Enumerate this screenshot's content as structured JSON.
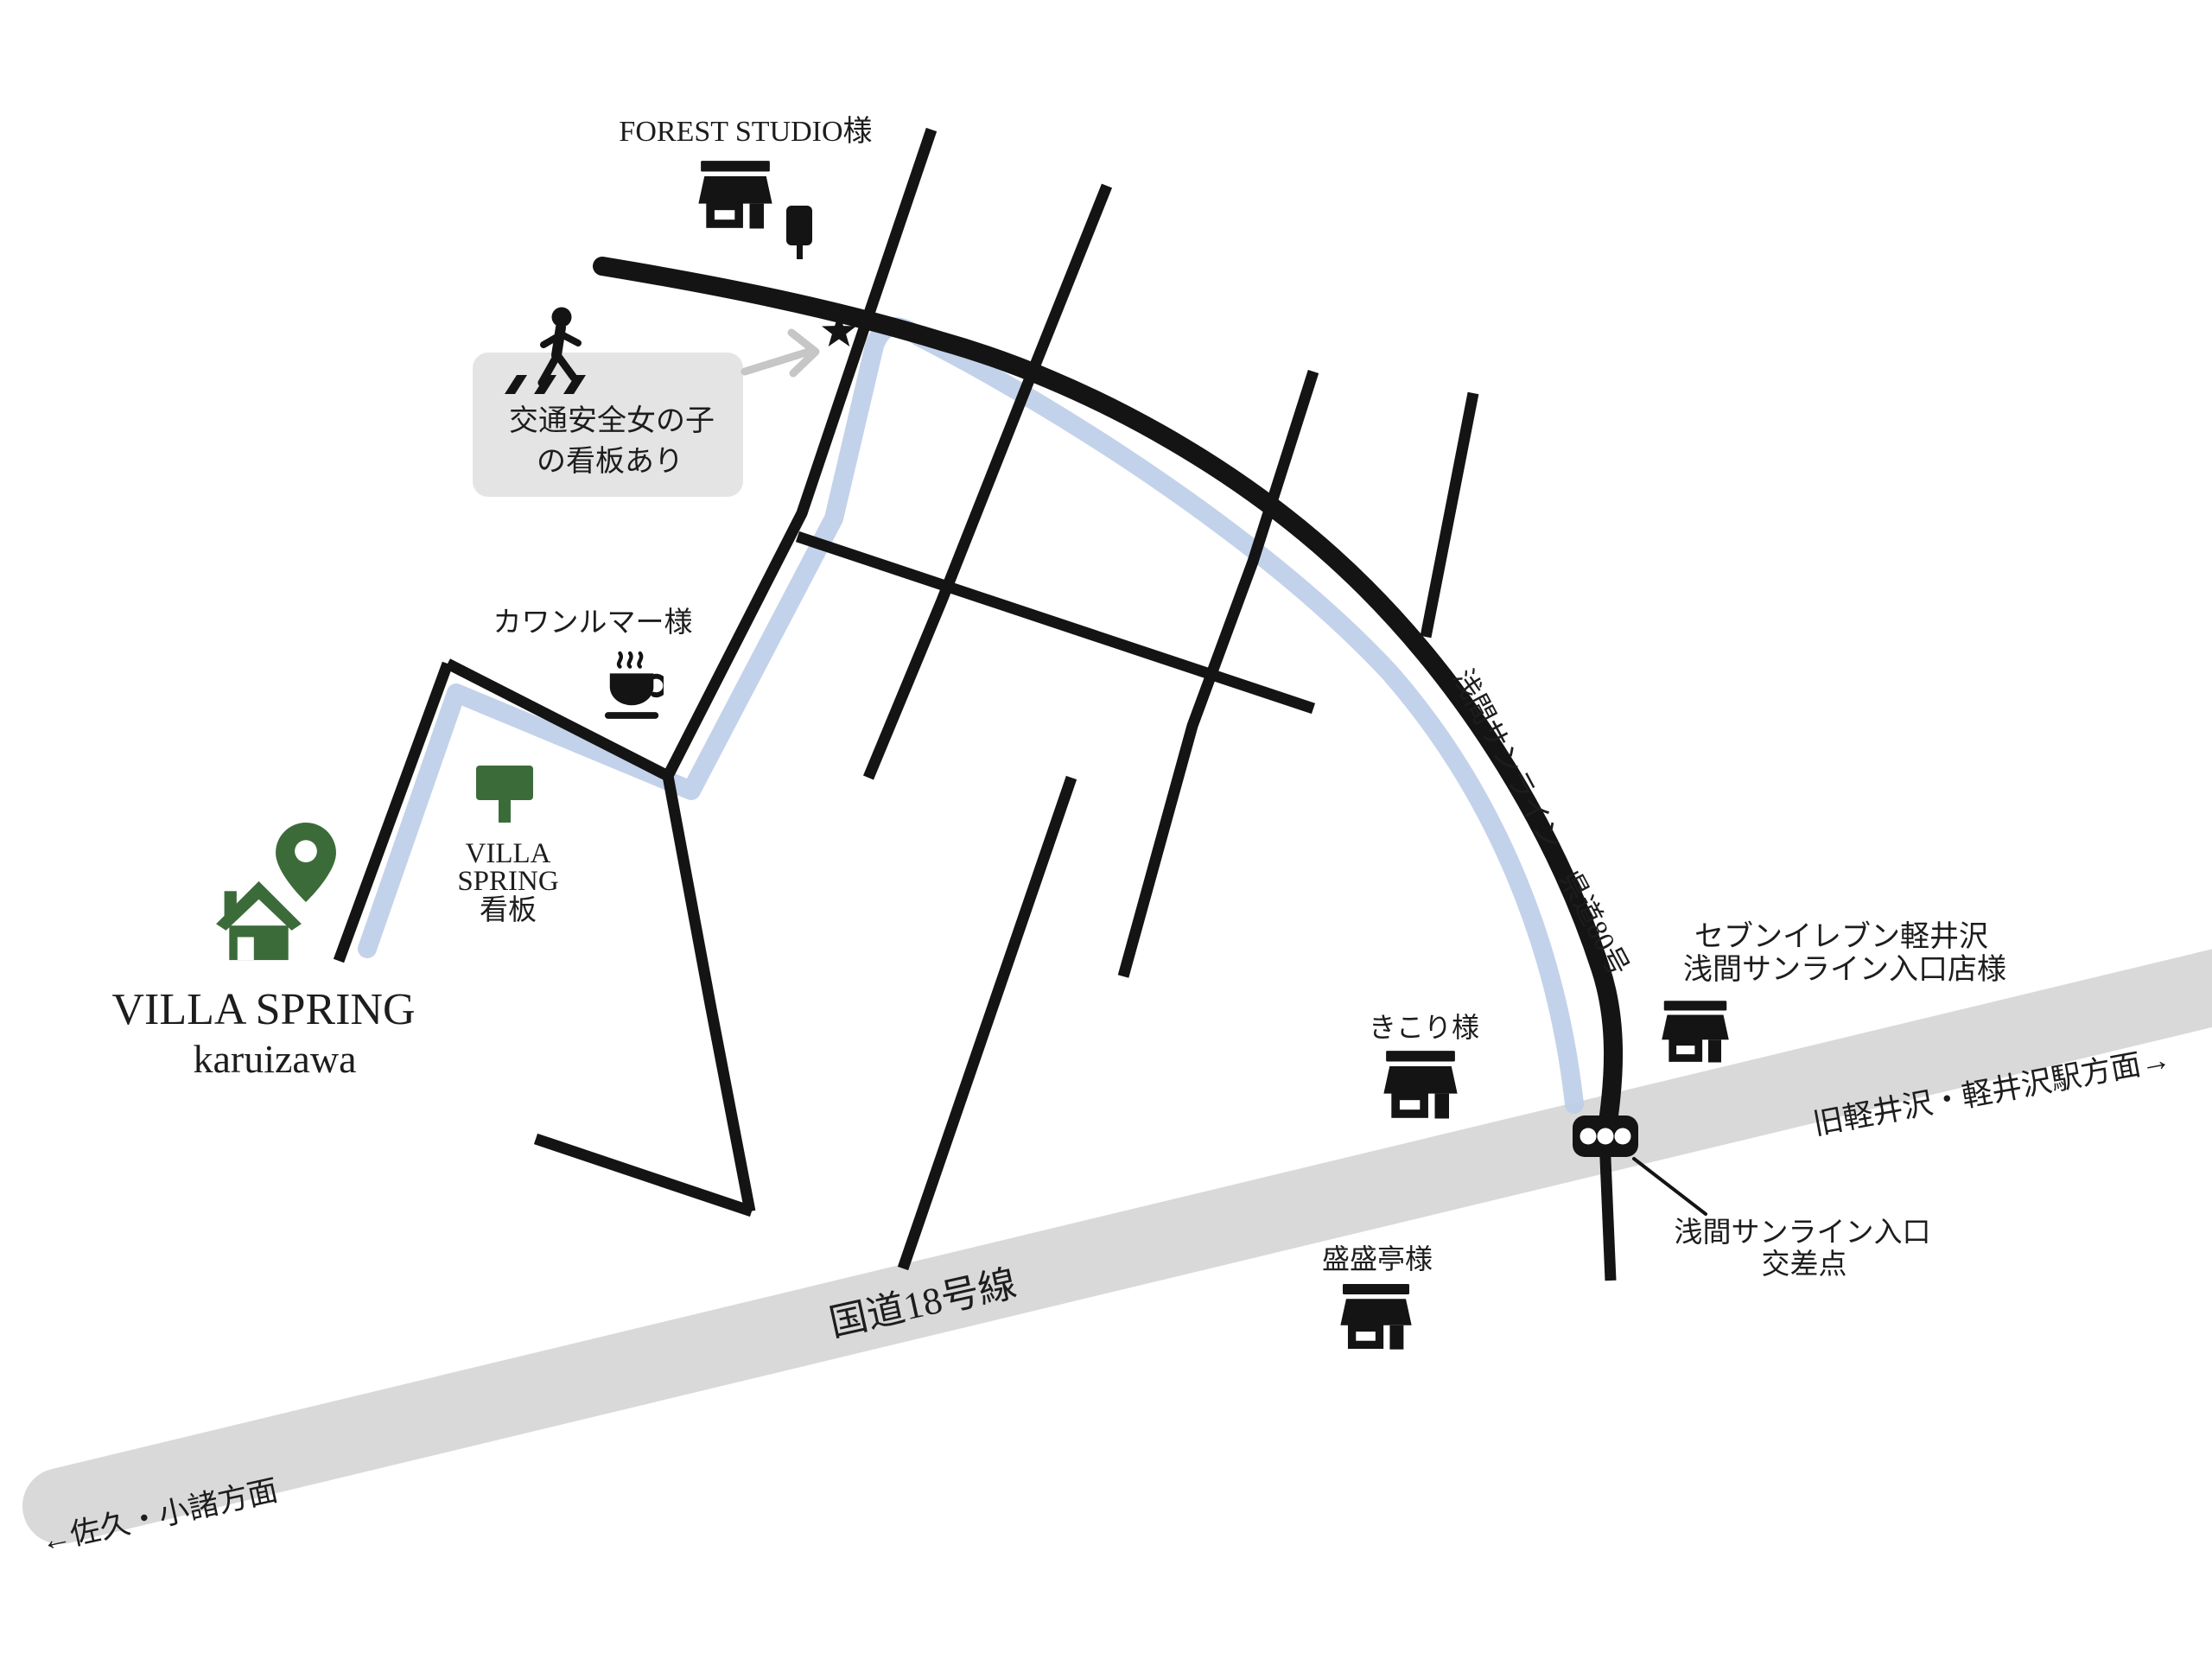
{
  "colors": {
    "background": "#ffffff",
    "road-black": "#141414",
    "road-gray": "#d9d9d9",
    "route-blue": "#bccde9",
    "box-gray": "#e4e4e4",
    "brand-green": "#3c6b3a",
    "ink": "#1d1d1d",
    "arrow-gray": "#c6c6c6"
  },
  "title": {
    "line1": "VILLA SPRING",
    "line2": "karuizawa"
  },
  "landmarks": {
    "forest_studio": "FOREST STUDIO様",
    "kawanrumaa": "カワンルマー様",
    "kikori": "きこり様",
    "seiseitei": "盛盛亭様",
    "seven_eleven_line1": "セブンイレブン軽井沢",
    "seven_eleven_line2": "浅間サンライン入口店様",
    "villa_sign_line1": "VILLA",
    "villa_sign_line2": "SPRING",
    "villa_sign_line3": "看板"
  },
  "roads": {
    "route18": "国道18号線",
    "sunline": "浅間サンライン　県道80号"
  },
  "directions": {
    "saku_komoro": "←佐久・小諸方面",
    "karuizawa_sta": "旧軽井沢・軽井沢駅方面→"
  },
  "intersection": {
    "line1": "浅間サンライン入口",
    "line2": "交差点"
  },
  "note": {
    "line1": "交通安全女の子",
    "line2": "の看板あり"
  },
  "icons": {
    "pin": "map-pin",
    "house": "house",
    "store": "storefront",
    "coffee": "coffee-cup",
    "pedestrian": "pedestrian-crossing",
    "traffic_light": "traffic-light",
    "star": "star",
    "sign": "green-signboard",
    "banner": "shop-banner",
    "arrow": "note-arrow"
  }
}
